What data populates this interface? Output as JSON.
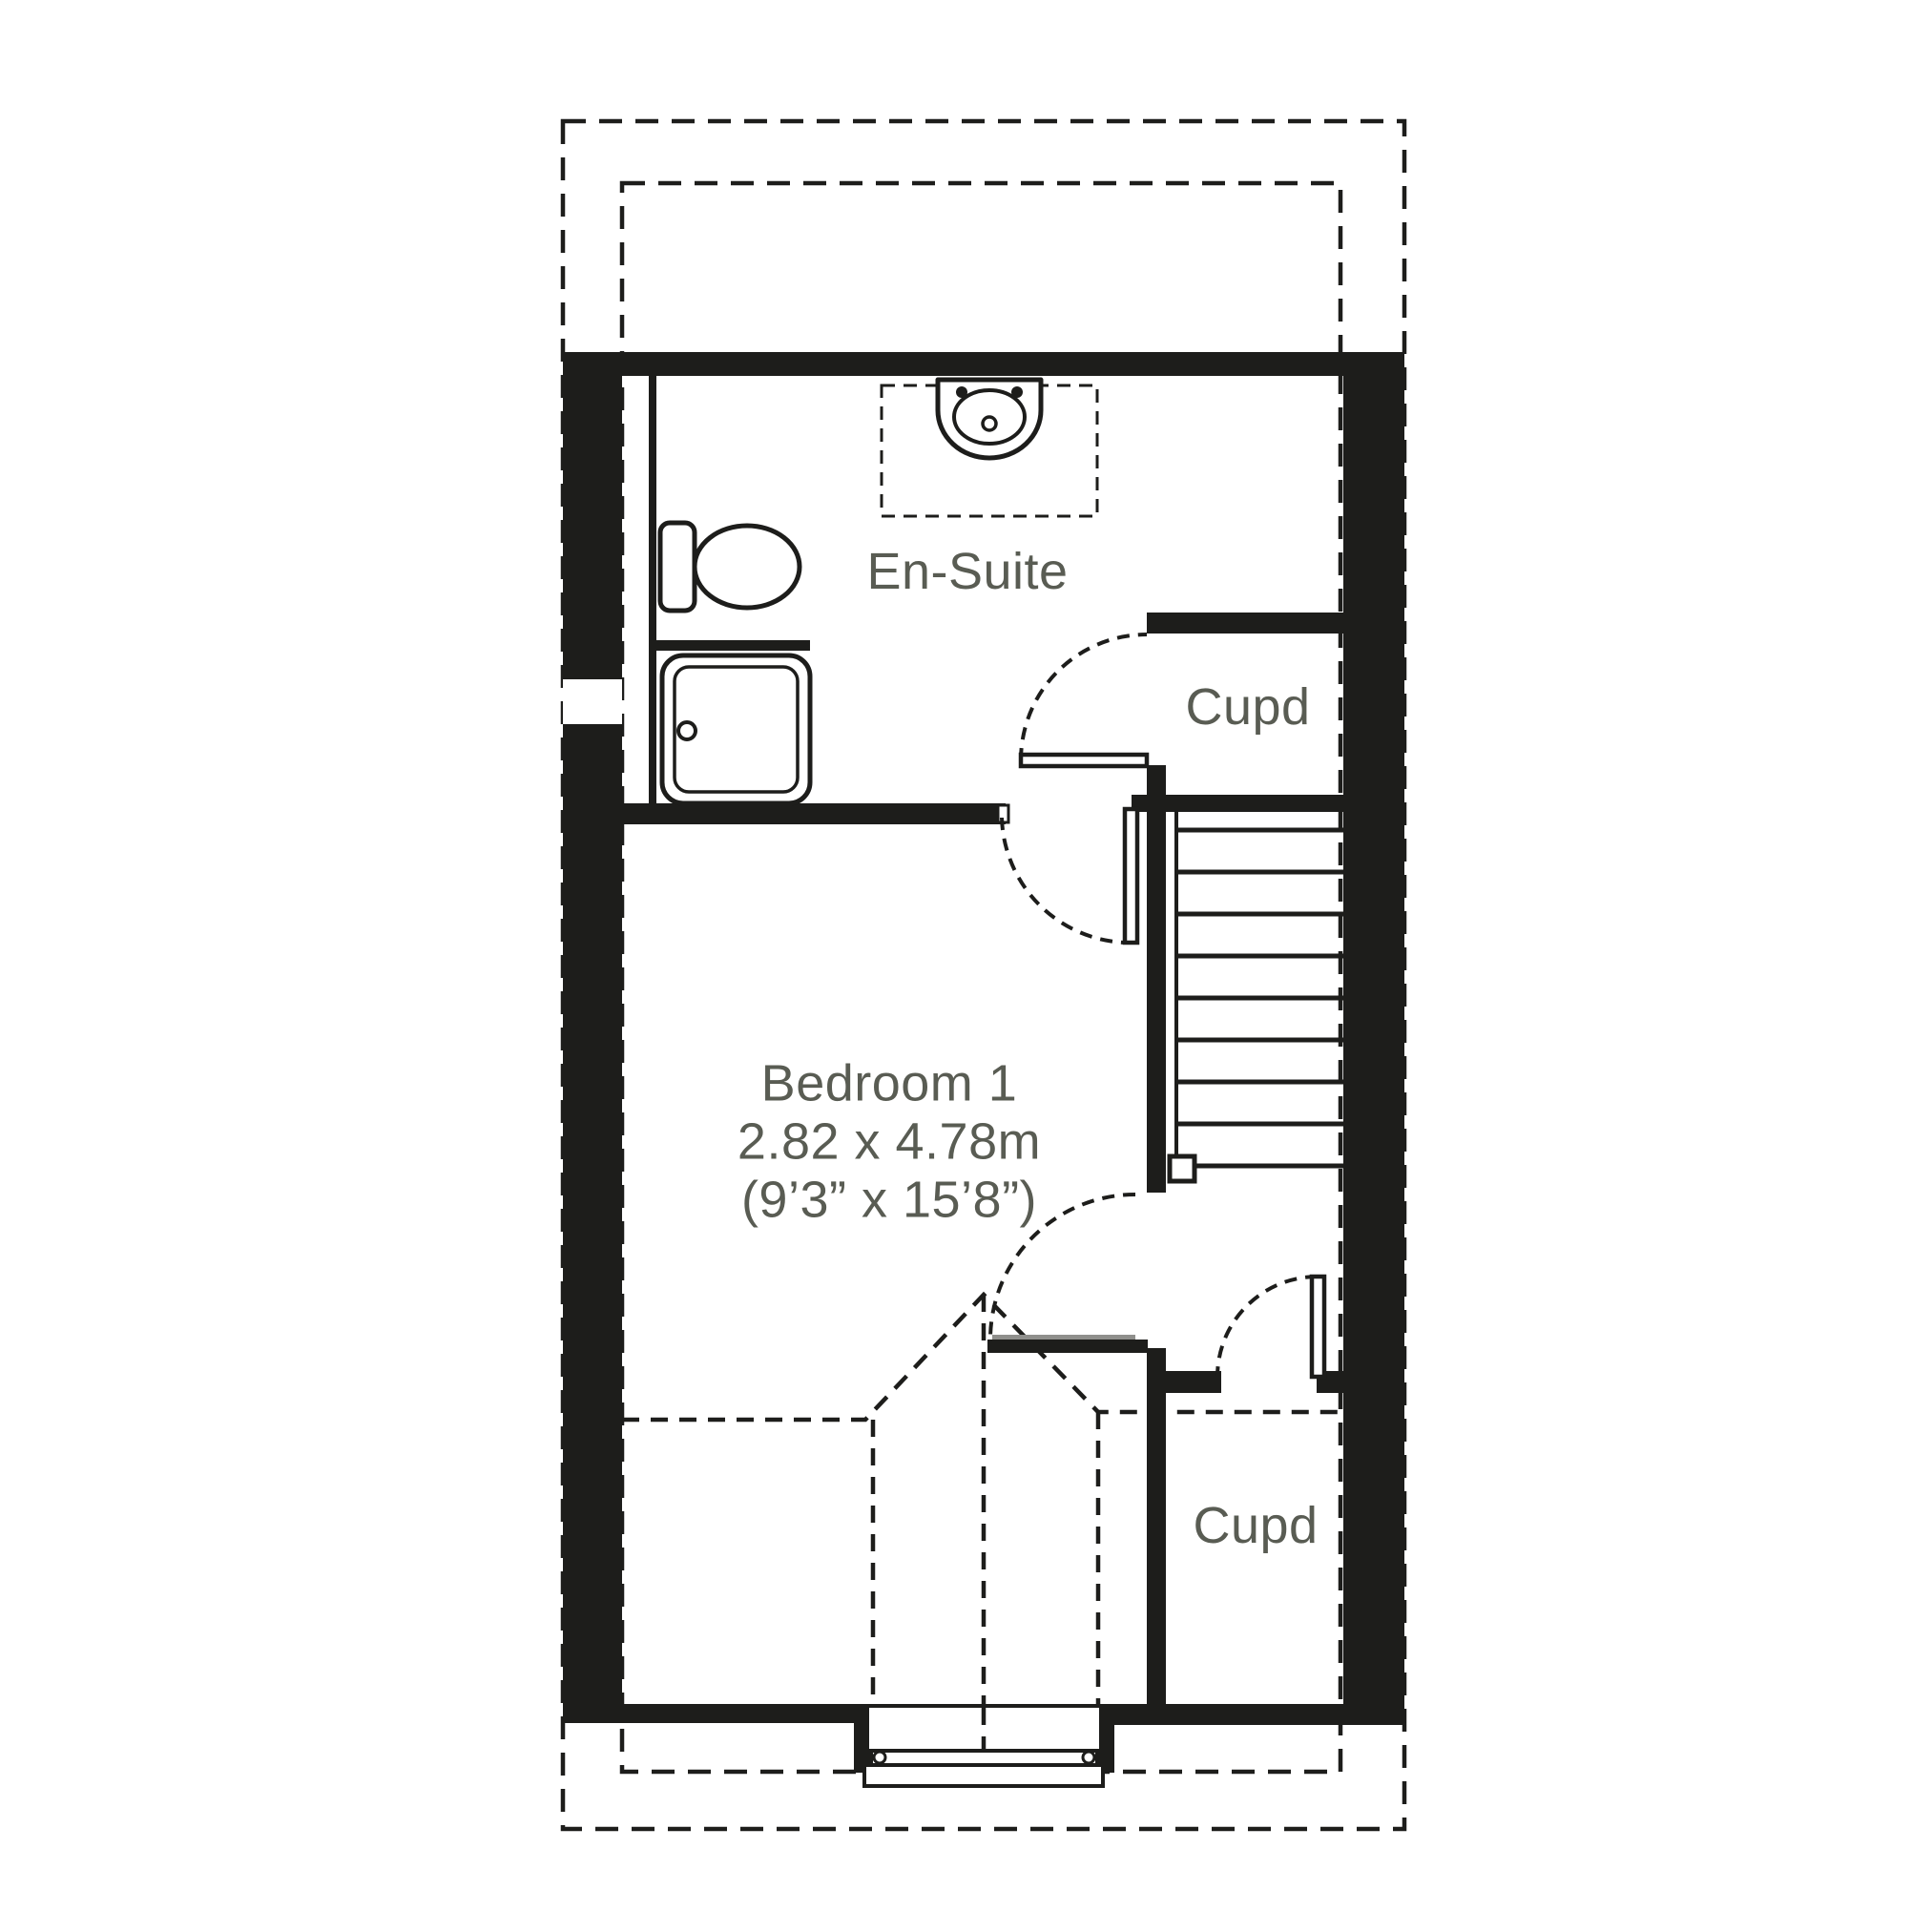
{
  "plan": {
    "title": "First floor plan",
    "labels": {
      "ensuite": "En-Suite",
      "cupboard_top": "Cupd",
      "cupboard_bottom": "Cupd",
      "bedroom": {
        "name": "Bedroom 1",
        "size_metric": "2.82 x 4.78m",
        "size_imperial": "(9’3” x 15’8”)"
      }
    },
    "fixtures": [
      "toilet",
      "basin",
      "shower-tray",
      "staircase",
      "dormer-window",
      "door-swings"
    ],
    "colors": {
      "wall": "#1d1d1b",
      "label": "#595c53",
      "bg": "#ffffff",
      "leafgray": "#8f8f8c"
    }
  }
}
